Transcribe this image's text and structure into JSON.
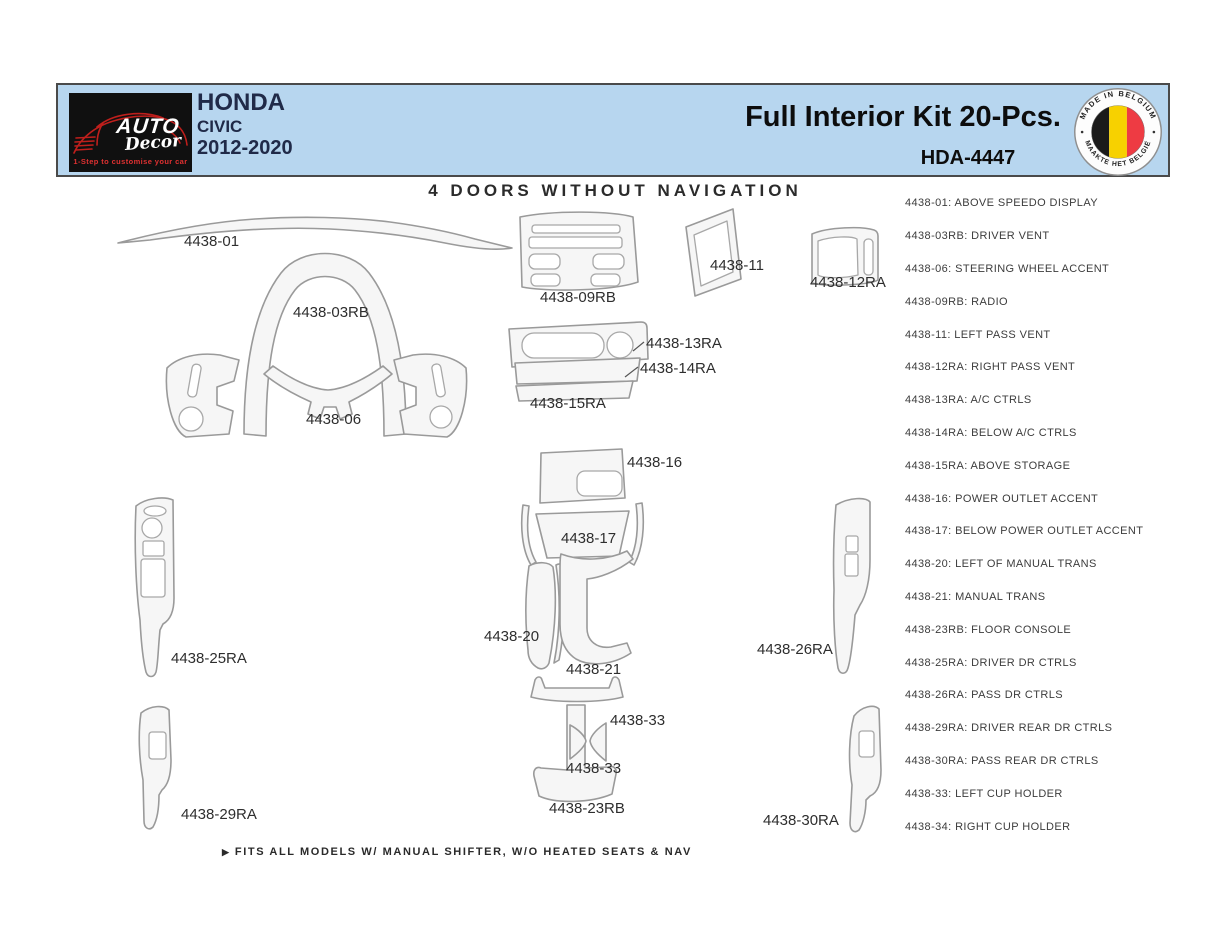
{
  "header": {
    "logo": {
      "brand_primary": "AUTO",
      "brand_secondary": "Decor",
      "tagline": "1-Step to customise your car"
    },
    "vehicle": {
      "make": "HONDA",
      "model": "CIVIC",
      "years": "2012-2020"
    },
    "kit_title": "Full Interior Kit 20-Pcs.",
    "kit_code": "HDA-4447",
    "badge": {
      "top_text": "MADE IN BELGIUM",
      "bottom_text": "MAAKTE HET BELGIË"
    }
  },
  "diagram": {
    "title": "4 DOORS WITHOUT NAVIGATION",
    "footnote_icon": "▶",
    "footnote": "FITS ALL MODELS W/ MANUAL SHIFTER, W/O HEATED SEATS & NAV",
    "labels": [
      "4438-01",
      "4438-03RB",
      "4438-06",
      "4438-09RB",
      "4438-11",
      "4438-12RA",
      "4438-13RA",
      "4438-14RA",
      "4438-15RA",
      "4438-16",
      "4438-17",
      "4438-20",
      "4438-21",
      "4438-23RB",
      "4438-25RA",
      "4438-26RA",
      "4438-29RA",
      "4438-30RA",
      "4438-33",
      "4438-33"
    ]
  },
  "legend": {
    "items": [
      "4438-01: ABOVE SPEEDO DISPLAY",
      "4438-03RB: DRIVER VENT",
      "4438-06: STEERING WHEEL ACCENT",
      "4438-09RB: RADIO",
      "4438-11: LEFT PASS VENT",
      "4438-12RA: RIGHT PASS VENT",
      "4438-13RA: A/C CTRLS",
      "4438-14RA: BELOW A/C CTRLS",
      "4438-15RA: ABOVE STORAGE",
      "4438-16: POWER OUTLET ACCENT",
      "4438-17: BELOW POWER OUTLET ACCENT",
      "4438-20: LEFT OF MANUAL TRANS",
      "4438-21: MANUAL TRANS",
      "4438-23RB: FLOOR CONSOLE",
      "4438-25RA: DRIVER DR CTRLS",
      "4438-26RA: PASS DR CTRLS",
      "4438-29RA: DRIVER REAR DR CTRLS",
      "4438-30RA: PASS REAR DR CTRLS",
      "4438-33: LEFT CUP HOLDER",
      "4438-34: RIGHT CUP HOLDER"
    ]
  },
  "colors": {
    "header_bg": "#b7d6ef",
    "logo_bg": "#101010",
    "logo_red": "#c9201d",
    "brand_text": "#202a48",
    "part_fill": "#f6f6f6",
    "part_stroke": "#9a9a9a",
    "flag_black": "#1a1a1a",
    "flag_yellow": "#f7d100",
    "flag_red": "#ee3b43"
  }
}
